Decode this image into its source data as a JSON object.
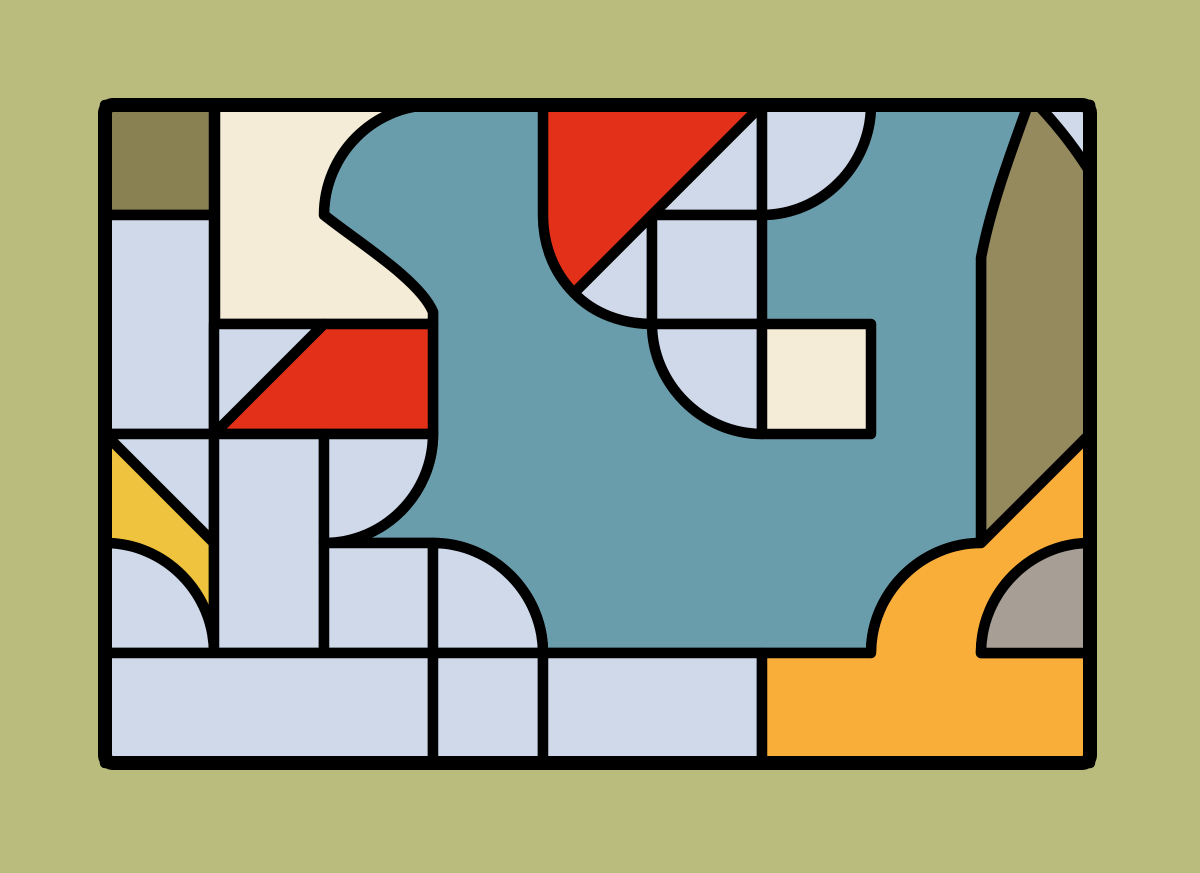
{
  "artwork": {
    "title": "abstract-geometric-stained-glass-panel",
    "canvas": {
      "width": 1200,
      "height": 873,
      "background": "#b9bc7c"
    },
    "frame": {
      "x": 105,
      "y": 105,
      "width": 985,
      "height": 658,
      "stroke": "#000000",
      "stroke_width": 14,
      "corner_radius": 8
    },
    "line": {
      "color": "#000000",
      "width": 10.5
    },
    "palette": {
      "background": "#b9bc7c",
      "teal": "#6a9dac",
      "light_blue": "#cfd9ea",
      "cream": "#f5ecd7",
      "red": "#e23019",
      "yellow": "#efc33e",
      "orange": "#f9ae39",
      "olive_dark": "#8a8152",
      "olive_arch": "#958a5d",
      "gray": "#a79e95"
    },
    "shapes": [
      {
        "name": "olive-arch-column",
        "color": "olive_arch",
        "d": "M981,105 L1090,105 L1090,434 L981,543 Z"
      },
      {
        "name": "teal-blob",
        "color": "teal",
        "d": "M433,105 L1028,105 C1008,160 990,210 981,258 L981,543 C921,543 871,593 871,653 L543,653 C543,593 493,543 433,543 L324,543 C384,543 433,494 433,434 L433,312 C420,280 355,240 324,215 C324,155 373,105 433,105 Z"
      },
      {
        "name": "cream-blob",
        "color": "cream",
        "d": "M215,105 L433,105 C373,105 324,155 324,215 C355,240 420,280 433,312 L433,324 L215,324 Z"
      },
      {
        "name": "olive-corner-square",
        "color": "olive_dark",
        "d": "M105,105 L214,105 L214,215 L105,215 Z"
      },
      {
        "name": "left-tall-column",
        "color": "light_blue",
        "d": "M105,215 L214,215 L214,434 L105,434 Z"
      },
      {
        "name": "diagonal-cell-upper-triangle",
        "color": "light_blue",
        "d": "M214,324 L324,324 L214,434 Z"
      },
      {
        "name": "red-trapezoid",
        "color": "red",
        "d": "M324,324 L433,324 L433,434 L214,434 Z"
      },
      {
        "name": "lower-left-triangle",
        "color": "light_blue",
        "d": "M105,434 L214,434 L214,543 Z"
      },
      {
        "name": "yellow-ribbon",
        "color": "yellow",
        "d": "M105,434 L214,543 L214,653 C214,593 165,543 105,543 Z"
      },
      {
        "name": "bottom-left-quarter-disc",
        "color": "light_blue",
        "d": "M105,543 C165,543 214,593 214,653 L105,653 Z"
      },
      {
        "name": "mid-left-column",
        "color": "light_blue",
        "d": "M214,434 L324,434 L324,653 L214,653 Z"
      },
      {
        "name": "quarter-disc-c2r3",
        "color": "light_blue",
        "d": "M324,434 L433,434 C433,494 384,543 324,543 Z"
      },
      {
        "name": "square-c2r4",
        "color": "light_blue",
        "d": "M324,543 L433,543 L433,653 L324,653 Z"
      },
      {
        "name": "quarter-disc-c3r4",
        "color": "light_blue",
        "d": "M433,543 C493,543 543,593 543,653 L433,653 Z"
      },
      {
        "name": "bottom-strip-left",
        "color": "light_blue",
        "d": "M105,653 L433,653 L433,763 L105,763 Z"
      },
      {
        "name": "bottom-strip-mid",
        "color": "light_blue",
        "d": "M433,653 L543,653 L543,763 L433,763 Z"
      },
      {
        "name": "bottom-strip-right",
        "color": "light_blue",
        "d": "M543,653 L762,653 L762,763 L543,763 Z"
      },
      {
        "name": "red-rounded-shape",
        "color": "red",
        "d": "M543,105 L762,105 L574,293 C553,272 543,244 543,215 Z"
      },
      {
        "name": "fan-wedge",
        "color": "light_blue",
        "d": "M574,293 L652,215 L652,324 C623,324 594,314 574,293 Z"
      },
      {
        "name": "diagonal-triangle-c5r0",
        "color": "light_blue",
        "d": "M652,215 L762,105 L762,215 Z"
      },
      {
        "name": "square-c5r1",
        "color": "light_blue",
        "d": "M652,215 L762,215 L762,324 L652,324 Z"
      },
      {
        "name": "rounded-square-c5r2",
        "color": "light_blue",
        "d": "M652,324 L762,324 L762,434 C702,434 652,384 652,324 Z"
      },
      {
        "name": "quarter-disc-c6r0",
        "color": "light_blue",
        "d": "M762,105 L871,105 C871,165 822,215 762,215 Z"
      },
      {
        "name": "cream-square-c6r2",
        "color": "cream",
        "d": "M762,324 L871,324 L871,434 L762,434 Z"
      },
      {
        "name": "corner-sliver",
        "color": "light_blue",
        "d": "M1038,105 L1090,105 L1090,172 C1075,148 1056,124 1038,105 Z"
      },
      {
        "name": "orange-hill-region",
        "color": "orange",
        "d": "M762,653 L871,653 C871,593 921,543 981,543 L1090,434 L1090,543 C1030,543 981,593 981,653 L1090,653 L1090,763 L762,763 Z"
      },
      {
        "name": "gray-quarter-disc",
        "color": "gray",
        "d": "M981,653 C981,593 1030,543 1090,543 L1090,653 Z"
      }
    ]
  }
}
